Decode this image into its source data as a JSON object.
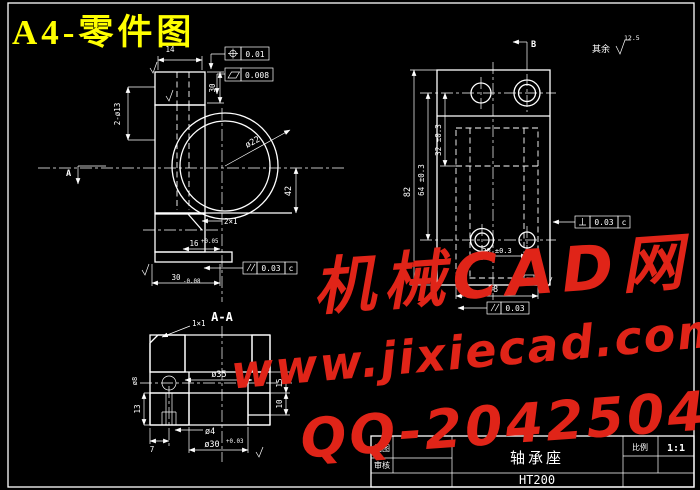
{
  "page": {
    "title": "A4-零件图"
  },
  "watermark": {
    "site_name": "机械CAD网",
    "url": "www.jixiecad.com",
    "qq": "QQ-20425042"
  },
  "general_roughness": {
    "prefix": "其余",
    "value": "12.5"
  },
  "front_view": {
    "section_arrow_label": "A",
    "dim_top_width": "14",
    "dim_boss_height": "30",
    "dim_holes": "2-ø13",
    "dim_bore": "ø22",
    "dim_center_height": "42",
    "chamfer_note": "2×1",
    "dim_hub_width": "16",
    "dim_hub_width_tol": "+0.05",
    "dim_base_width": "30",
    "dim_base_width_tol": "-0.08",
    "fcf_position": {
      "symbol": "position",
      "value": "0.01"
    },
    "fcf_flatness": {
      "symbol": "flatness",
      "value": "0.008"
    },
    "fcf_parallel": {
      "symbol": "parallelism",
      "value": "0.03",
      "datum": "c"
    }
  },
  "side_view": {
    "section_arrow_label": "B",
    "datum_label": "B",
    "dim_height": "82",
    "dim_hole_span": "64 ±0.3",
    "dim_upper_span": "32 ±0.3",
    "dim_slot": "20 ±0.3",
    "dim_width": "38",
    "fcf_perpendicular": {
      "symbol": "perpendicularity",
      "value": "0.03",
      "datum": "c"
    },
    "fcf_parallel": {
      "symbol": "parallelism",
      "value": "0.03"
    }
  },
  "section_view": {
    "label": "A-A",
    "chamfer_note": "1×1",
    "dim_bore_upper": "ø35",
    "dim_step_upper": "15",
    "dim_step_lower": "10",
    "dim_hole_depth": "13",
    "dim_hole_offset": "7",
    "dim_small_hole": "ø4",
    "dim_counterbore": "ø8",
    "dim_bore_lower": "ø30",
    "dim_bore_lower_tol": "+0.03"
  },
  "title_block": {
    "row1_label": "制图",
    "row2_label": "审核",
    "part_name": "轴承座",
    "material": "HT200",
    "scale_label": "比例",
    "scale_value": "1:1"
  }
}
